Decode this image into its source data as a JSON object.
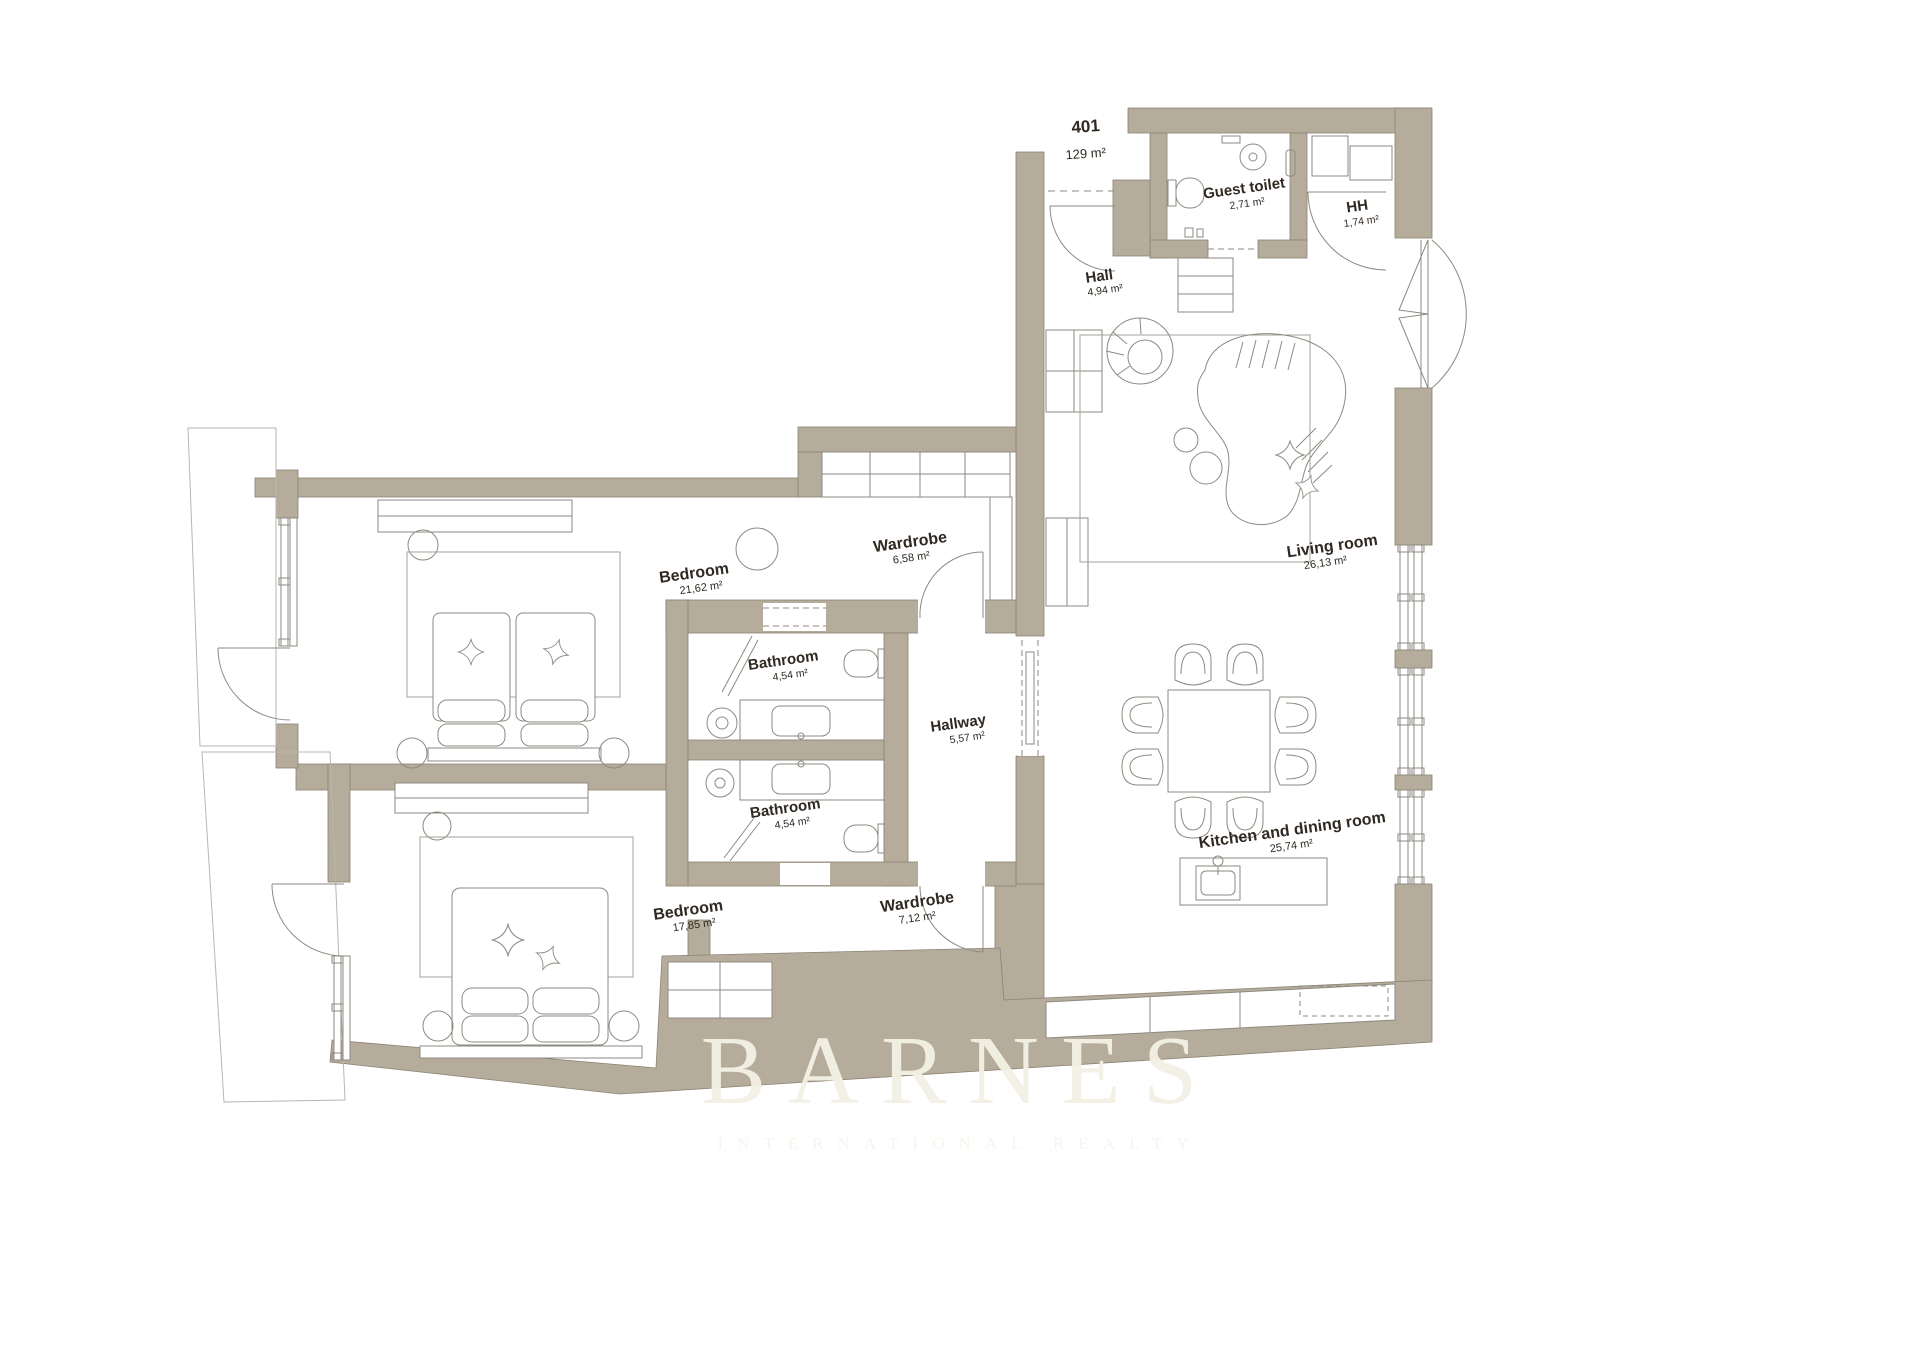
{
  "plan": {
    "unit": {
      "number": "401",
      "area": "129 m²"
    },
    "rooms": {
      "guest_toilet": {
        "name": "Guest toilet",
        "area": "2,71 m²"
      },
      "hh": {
        "name": "HH",
        "area": "1,74 m²"
      },
      "hall": {
        "name": "Hall",
        "area": "4,94 m²"
      },
      "living_room": {
        "name": "Living room",
        "area": "26,13 m²"
      },
      "bedroom_1": {
        "name": "Bedroom",
        "area": "21,62 m²"
      },
      "wardrobe_1": {
        "name": "Wardrobe",
        "area": "6,58 m²"
      },
      "bathroom_1": {
        "name": "Bathroom",
        "area": "4,54 m²"
      },
      "hallway": {
        "name": "Hallway",
        "area": "5,57 m²"
      },
      "bathroom_2": {
        "name": "Bathroom",
        "area": "4,54 m²"
      },
      "bedroom_2": {
        "name": "Bedroom",
        "area": "17,85 m²"
      },
      "wardrobe_2": {
        "name": "Wardrobe",
        "area": "7,12 m²"
      },
      "kitchen_dining": {
        "name": "Kitchen and dining room",
        "area": "25,74 m²"
      }
    },
    "watermark": {
      "brand": "BARNES",
      "tagline": "INTERNATIONAL REALTY"
    },
    "colors": {
      "wall": "#b6ac9b",
      "line": "#8d8a80",
      "label": "#2f2922",
      "watermark": "#f2eee3"
    }
  }
}
